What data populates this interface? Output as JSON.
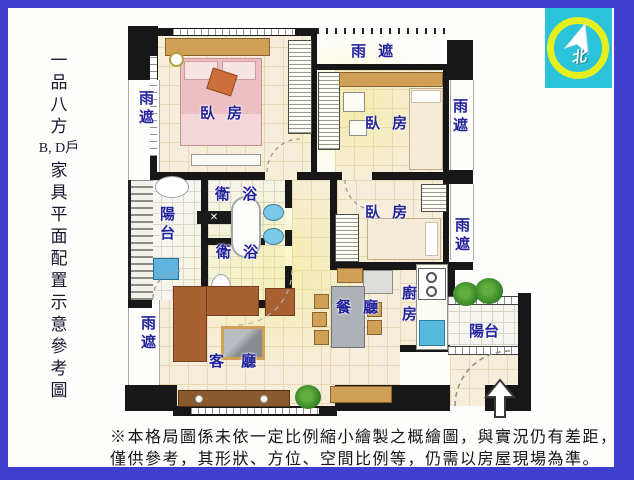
{
  "sidebar": {
    "chars": [
      "一",
      "品",
      "八",
      "方",
      "B, D戶",
      "家",
      "具",
      "平",
      "面",
      "配",
      "置",
      "示",
      "意",
      "參",
      "考",
      "圖"
    ]
  },
  "compass": {
    "label": "北"
  },
  "plan": {
    "canopy": "雨遮",
    "canopy_spaced": "雨 遮",
    "bedroom": "臥 房",
    "bathroom": "衛 浴",
    "balcony": "陽台",
    "living_room": "客 廳",
    "dining_room": "餐 廳",
    "kitchen": "廚房",
    "label_color": "#23239b",
    "wall_color": "#171717"
  },
  "disclaimer": {
    "line1": "※本格局圖係未依一定比例縮小繪製之概繪圖，與實況仍有差距，",
    "line2": "僅供參考，其形狀、方位、空間比例等，仍需以房屋現場為準。"
  }
}
